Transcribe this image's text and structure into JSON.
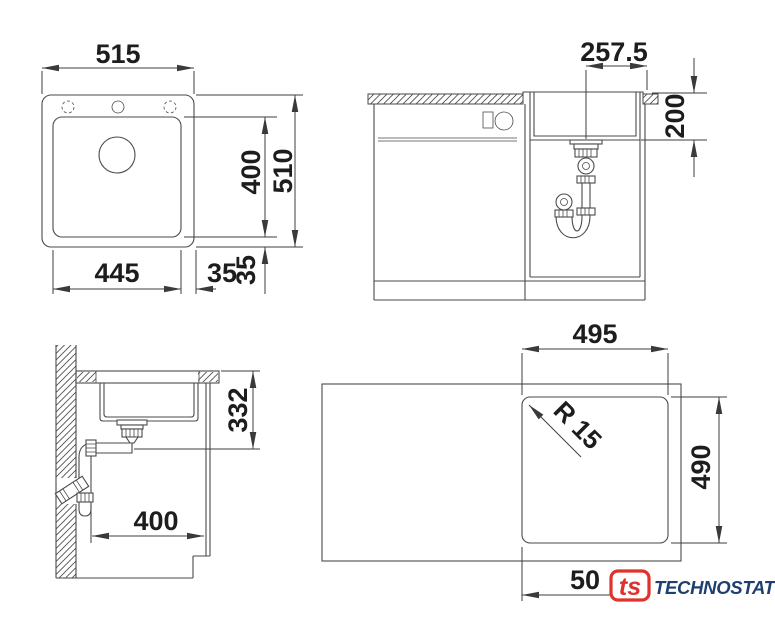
{
  "top_view": {
    "overall_width": "515",
    "bowl_width": "445",
    "side_gap": "35",
    "bottom_gap": "35",
    "bowl_length": "400",
    "overall_depth": "510"
  },
  "front_view": {
    "drain_offset": "257.5",
    "bowl_depth": "200"
  },
  "side_view": {
    "drain_height": "332",
    "clearance": "400"
  },
  "cutout_view": {
    "cutout_width": "495",
    "cutout_height": "490",
    "corner_radius": "R 15",
    "edge_dim": "50"
  },
  "logo": {
    "mark": "ts",
    "brand": "TECHNOSTATUS"
  },
  "colors": {
    "logo_red": "#e0312b",
    "logo_blue": "#1e3f6f",
    "line": "#4a4a4a"
  }
}
